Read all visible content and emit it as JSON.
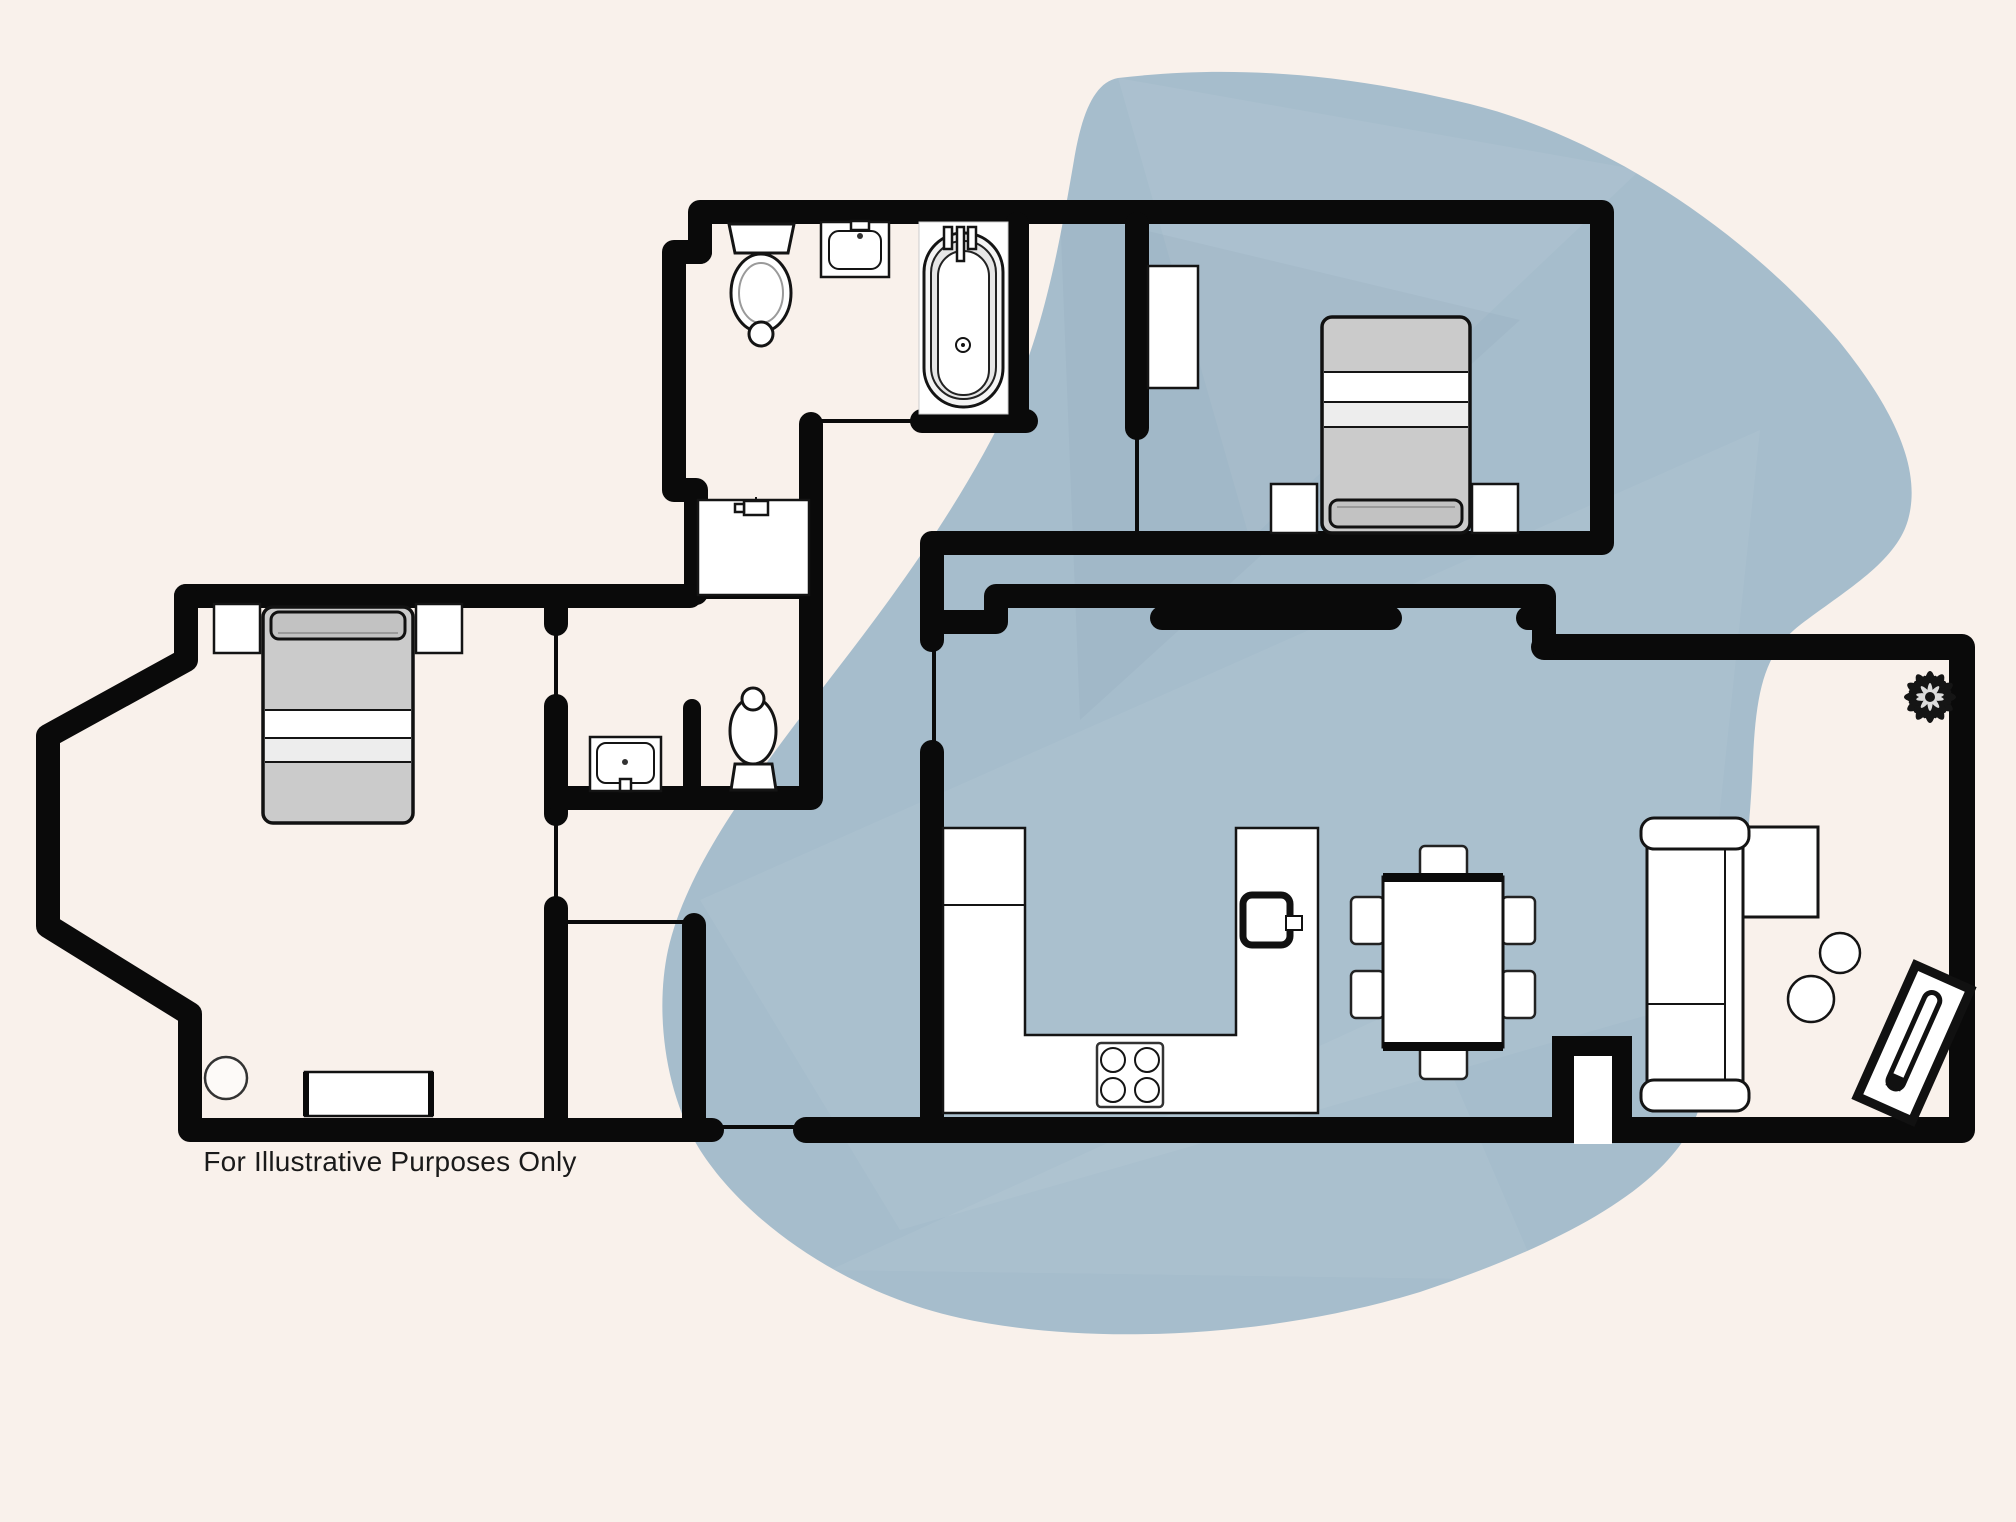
{
  "caption": {
    "text": "For Illustrative Purposes Only"
  },
  "colors": {
    "background": "#f9f1eb",
    "blob": "#a6bdcc",
    "wall": "#0a0a0a",
    "bed_fill": "#cbcbcb",
    "bed_headboard": "#c2c2c2",
    "bed_sheet_light": "#ededed",
    "fixture_fill": "#ffffff",
    "fixture_stroke": "#141414",
    "caption_color": "#1a1a1a"
  },
  "icons": [
    "toilet-icon",
    "bathroom-sink-icon",
    "bathtub-icon",
    "double-bed-icon",
    "nightstand-icon",
    "wardrobe-icon",
    "utility-tap-icon",
    "stove-icon",
    "kitchen-counter-icon",
    "kitchen-sink-icon",
    "dining-table-icon",
    "dining-chair-icon",
    "sofa-icon",
    "side-table-icon",
    "console-table-icon",
    "plant-icon",
    "stool-icon",
    "dresser-icon",
    "fireplace-niche-icon"
  ]
}
